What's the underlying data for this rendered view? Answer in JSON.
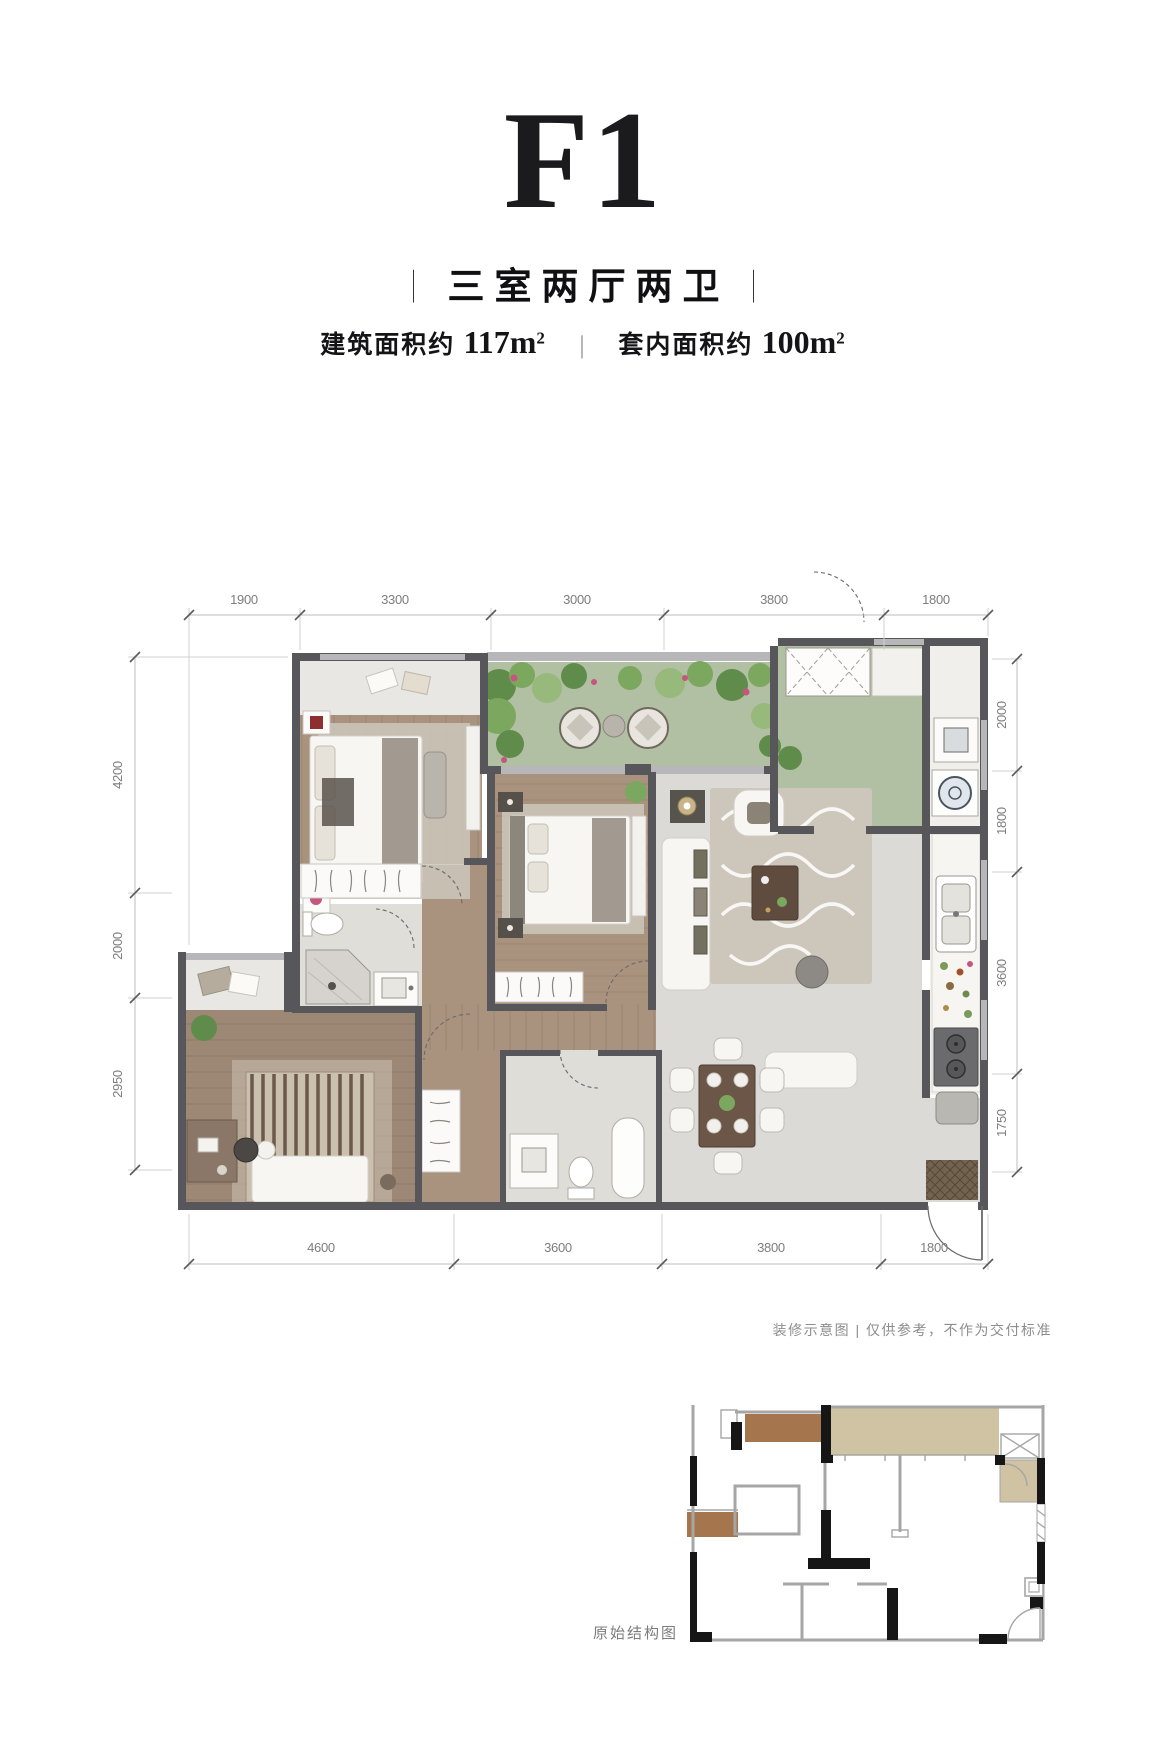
{
  "header": {
    "title": "F1",
    "bar": "|",
    "subtitle": "三室两厅两卫",
    "area": {
      "left_label": "建筑面积约",
      "left_value": "117m",
      "left_sup": "2",
      "divider": "|",
      "right_label": "套内面积约",
      "right_value": "100m",
      "right_sup": "2"
    }
  },
  "plan": {
    "dimensions": {
      "top": [
        "1900",
        "3300",
        "3000",
        "3800",
        "1800"
      ],
      "bottom": [
        "4600",
        "3600",
        "3800",
        "1800"
      ],
      "left": [
        "4200",
        "2000",
        "2950"
      ],
      "right": [
        "2000",
        "1800",
        "3600",
        "1750"
      ]
    },
    "icons": [
      "bed",
      "sofa",
      "armchair",
      "dining-table",
      "washing-machine",
      "stove",
      "kitchen-sink",
      "toilet",
      "bathtub",
      "shower",
      "wardrobe-hangers",
      "plant",
      "entry-door",
      "coffee-table",
      "desk"
    ],
    "colors": {
      "wall": "#56565b",
      "wall_light": "#b7b7b9",
      "wood_floor": "#a9937f",
      "wood_floor_2": "#9d8775",
      "marble_floor": "#dbdad6",
      "marble_light": "#e9e7e3",
      "terrace_green": "#b1bfa2",
      "plant_dark": "#5f8c4a",
      "plant_mid": "#7ca75f",
      "plant_light": "#97b97c",
      "flower_pink": "#c4567f",
      "furniture_white": "#f7f6f3",
      "furniture_gray": "#a29a90",
      "rug": "#cdc7bb",
      "table_dark": "#5f4c3e",
      "accent_red": "#8e2f2f",
      "mat_brown": "#73634e"
    }
  },
  "notes": {
    "disclaimer": "装修示意图 | 仅供参考，不作为交付标准"
  },
  "structure": {
    "caption": "原始结构图",
    "colors": {
      "struct_wall": "#161616",
      "struct_line": "#a6a6a6",
      "struct_brown": "#a5754e",
      "struct_tan": "#cfc3a3"
    }
  }
}
